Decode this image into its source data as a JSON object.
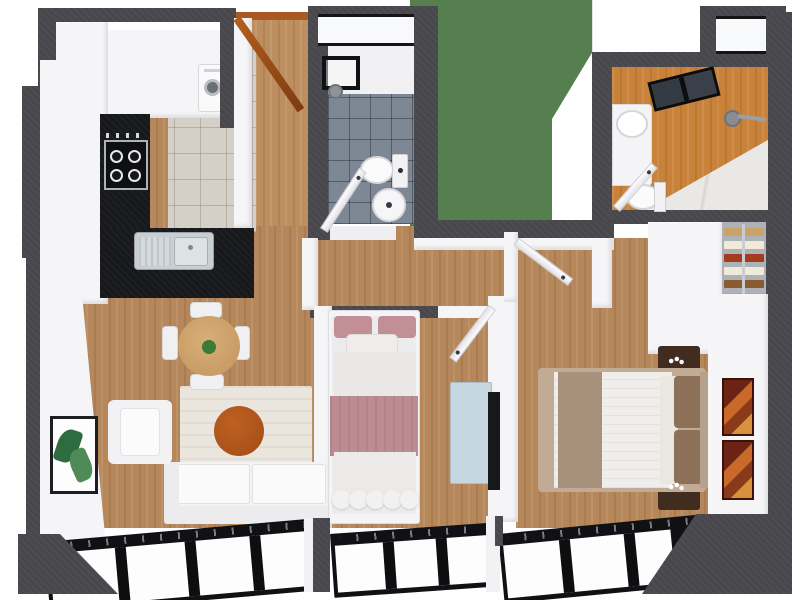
{
  "scene": {
    "palette": {
      "wall_dark": "#48484c",
      "wall_white": "#f5f5f7",
      "wood_floor": "#b5875a",
      "wood_entry": "#bd8f60",
      "kitchen_tile": "#d4cfc7",
      "counter_black": "#17181b",
      "bath1_tile": "#7e8794",
      "shower_floor": "#f1f1f3",
      "courtyard_green": "#567f50",
      "bath2_wood": "#c8823a",
      "bath2_marble": "#eae8e4",
      "bath2_tile": "#6a7480",
      "closet_shelf_bg": "#aeb2b8",
      "rug_beige": "#eae5dd",
      "pouf_orange": "#ad531d",
      "sofa_white": "#f3f3f5",
      "armchair_white": "#f2f2f4",
      "table_wood": "#cfa269",
      "plant_green": "#3c7a36",
      "bed2_pink": "#c28f96",
      "bed2_blanket": "#bd8b92",
      "dresser_blue": "#c6d7e1",
      "tv_black": "#17181a",
      "bed_frame_tan": "#c2ab94",
      "duvet_white": "#f0eeeb",
      "throw_taupe": "#a8917c",
      "pillow_brown": "#8d7058",
      "nightstand_brown": "#402d20",
      "frame_art_red": "#6b2413",
      "door_wood_orange": "#a85a20",
      "window_frame_black": "#101114",
      "shelf_tan": "#c8a36a",
      "shelf_cream": "#f0ead8",
      "shelf_red": "#a33b1c",
      "shelf_brown": "#8a5a32"
    },
    "rooms": [
      {
        "id": "kitchen",
        "floor": "tile"
      },
      {
        "id": "entry-hall",
        "floor": "wood"
      },
      {
        "id": "bathroom-main",
        "floor": "blue-gray-tile"
      },
      {
        "id": "light-court",
        "floor": "green"
      },
      {
        "id": "bathroom-ensuite",
        "floor": "marble"
      },
      {
        "id": "living-dining",
        "floor": "wood"
      },
      {
        "id": "bedroom-small",
        "floor": "wood"
      },
      {
        "id": "bedroom-master",
        "floor": "wood"
      },
      {
        "id": "walk-in-closet",
        "floor": "wood"
      }
    ],
    "furniture": [
      "stove-cooktop",
      "kitchen-sink",
      "washing-machine",
      "upper-cabinets",
      "toilet",
      "pedestal-sink",
      "shower-glass-panel",
      "shower-head",
      "skylight",
      "vanity-sink",
      "round-dining-table",
      "dining-chairs",
      "potted-plant",
      "armchair",
      "sofa",
      "area-rug",
      "orange-pouf",
      "botanical-wall-art",
      "single-bed-pink",
      "blue-dresser",
      "wall-tv",
      "double-bed",
      "nightstands",
      "flower-vases",
      "abstract-wall-art",
      "closet-shelves",
      "entry-door",
      "interior-doors",
      "x-marked-shaft-windows",
      "panoramic-windows"
    ]
  }
}
